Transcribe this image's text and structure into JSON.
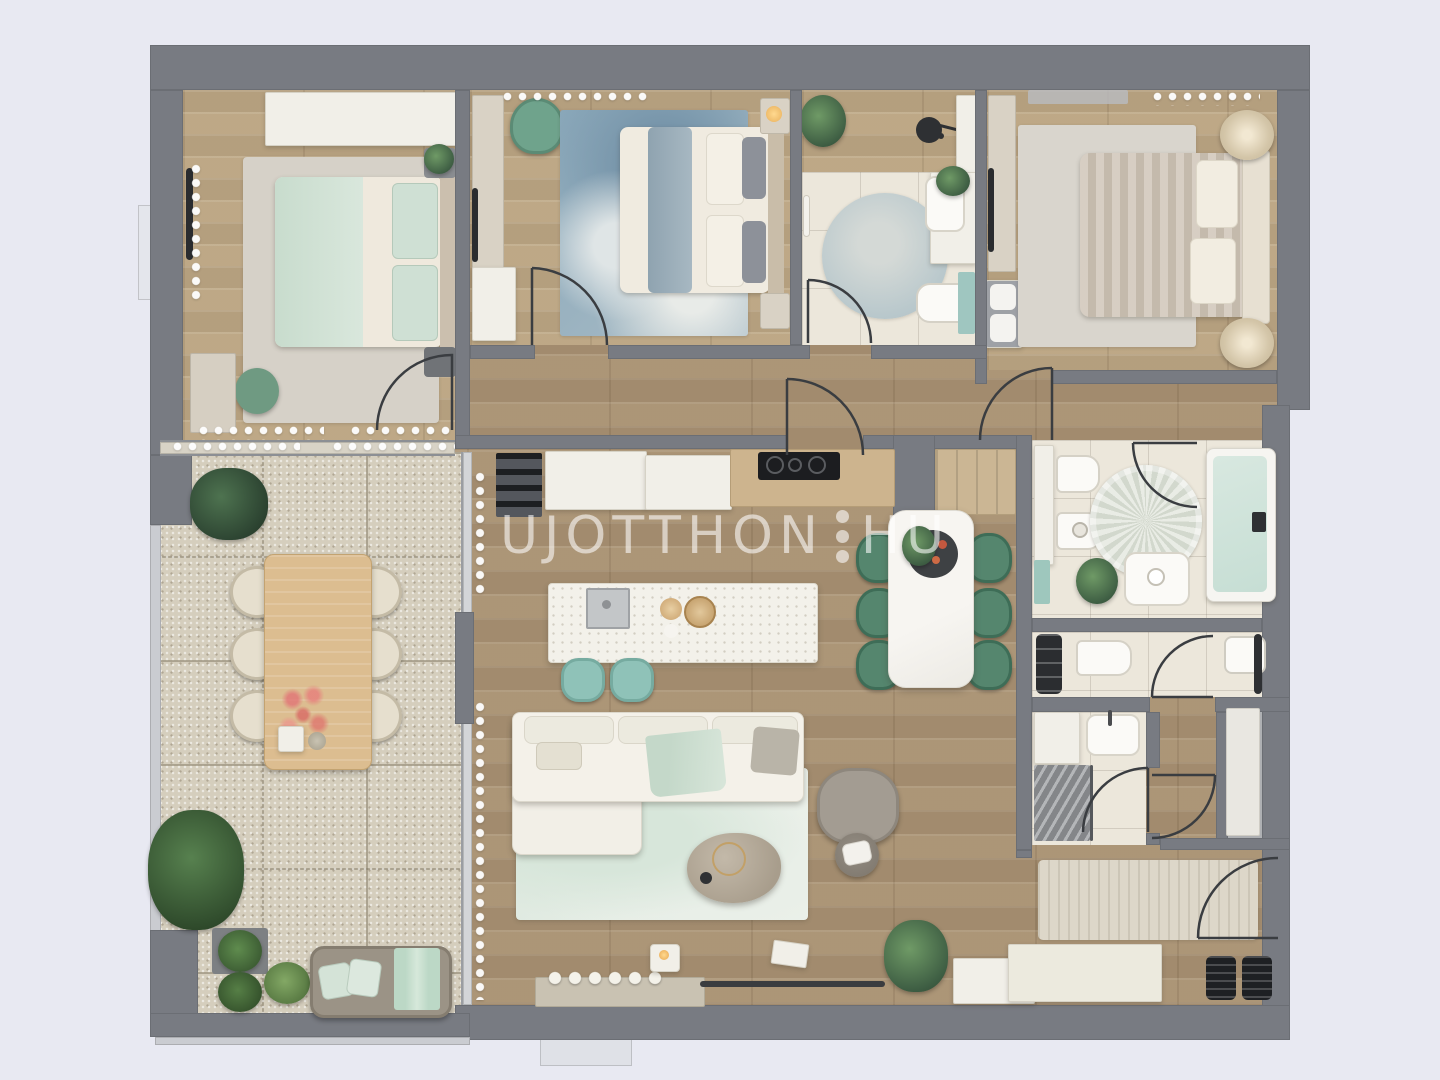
{
  "watermark": {
    "text_main": "UJOTTHON",
    "text_tld": "HU",
    "dot_count": 3
  },
  "palette": {
    "background": "#e8e9f2",
    "wall": "#787b82",
    "wood_floor_living": "#ad977a",
    "wood_floor_bedroom": "#c0ab8a",
    "tile_floor": "#ece7db",
    "terrace_tile": "#d5cebd",
    "accent_mint": "#cfe0d3",
    "accent_green_chair": "#55866e",
    "accent_teal_stool": "#8fc2b8",
    "blue_rug": "#8aa8ba",
    "bathtub_water": "#cfe3da",
    "watermark_color": "rgba(255,255,255,0.58)"
  },
  "floor_plan": {
    "type": "apartment-top-view-3d-render",
    "rooms": [
      {
        "id": "bedroom-1",
        "name": "Bedroom 1 (top-left)",
        "furniture": [
          "double bed with mint blanket",
          "gray area rug",
          "wardrobe along top wall",
          "green pouf",
          "two nightstands",
          "dresser",
          "window curtains"
        ]
      },
      {
        "id": "bedroom-2",
        "name": "Bedroom 2 (top-middle)",
        "furniture": [
          "double bed with blue-gray runner",
          "blue watercolor rug",
          "desk wall unit",
          "green armchair",
          "white dresser",
          "nightstand with lamp"
        ]
      },
      {
        "id": "bathroom-1",
        "name": "Bathroom (top-center)",
        "furniture": [
          "round blue rug",
          "washbasin vanity with plant",
          "toilet",
          "teal cabinet",
          "black pendant lamp",
          "tall cabinet"
        ]
      },
      {
        "id": "bedroom-3",
        "name": "Master bedroom (top-right)",
        "furniture": [
          "double bed with taupe duvet",
          "large gray rug",
          "TV dresser wall unit",
          "two round star side tables",
          "white cabinet"
        ]
      },
      {
        "id": "bathroom-2",
        "name": "Main bathroom (right)",
        "furniture": [
          "bathtub",
          "toilet",
          "bidet",
          "washbasin",
          "round fluffy rug",
          "plant",
          "teal towel"
        ]
      },
      {
        "id": "wc",
        "name": "WC",
        "furniture": [
          "toilet",
          "washbasin",
          "black shelf unit"
        ]
      },
      {
        "id": "shower-room",
        "name": "Shower room",
        "furniture": [
          "shower",
          "washbasin"
        ]
      },
      {
        "id": "closet",
        "name": "Closet / storage",
        "furniture": [
          "floor mat"
        ]
      },
      {
        "id": "hallway",
        "name": "Hallway",
        "furniture": []
      },
      {
        "id": "entry-hall",
        "name": "Entry hall (bottom-right)",
        "furniture": [
          "runner rug",
          "shoe cabinet",
          "two black doormats",
          "entry door"
        ]
      },
      {
        "id": "kitchen",
        "name": "Kitchen",
        "furniture": [
          "dark shelf unit",
          "white counters",
          "wood counter with black cooktop",
          "terrazzo island with sink",
          "two teal bar stools",
          "wood bowls"
        ]
      },
      {
        "id": "dining-area",
        "name": "Dining area",
        "furniture": [
          "white marble table",
          "six green chairs",
          "centerpiece tray with greens"
        ]
      },
      {
        "id": "living-room",
        "name": "Living room",
        "furniture": [
          "white L-shaped sectional sofa",
          "mint leaf-pattern rug",
          "oval stone coffee table",
          "gray armchair",
          "round side table",
          "media console with decor",
          "candle",
          "books",
          "plant",
          "TV panel"
        ]
      },
      {
        "id": "terrace",
        "name": "Terrace (left)",
        "furniture": [
          "wood dining table",
          "six beige chairs",
          "pink flower vase",
          "daybed with mint pillows and throw",
          "potted plants",
          "large plant"
        ]
      }
    ],
    "windows": [
      "top wall x3",
      "left wall x1",
      "bottom wall x1"
    ],
    "doors": 10
  }
}
